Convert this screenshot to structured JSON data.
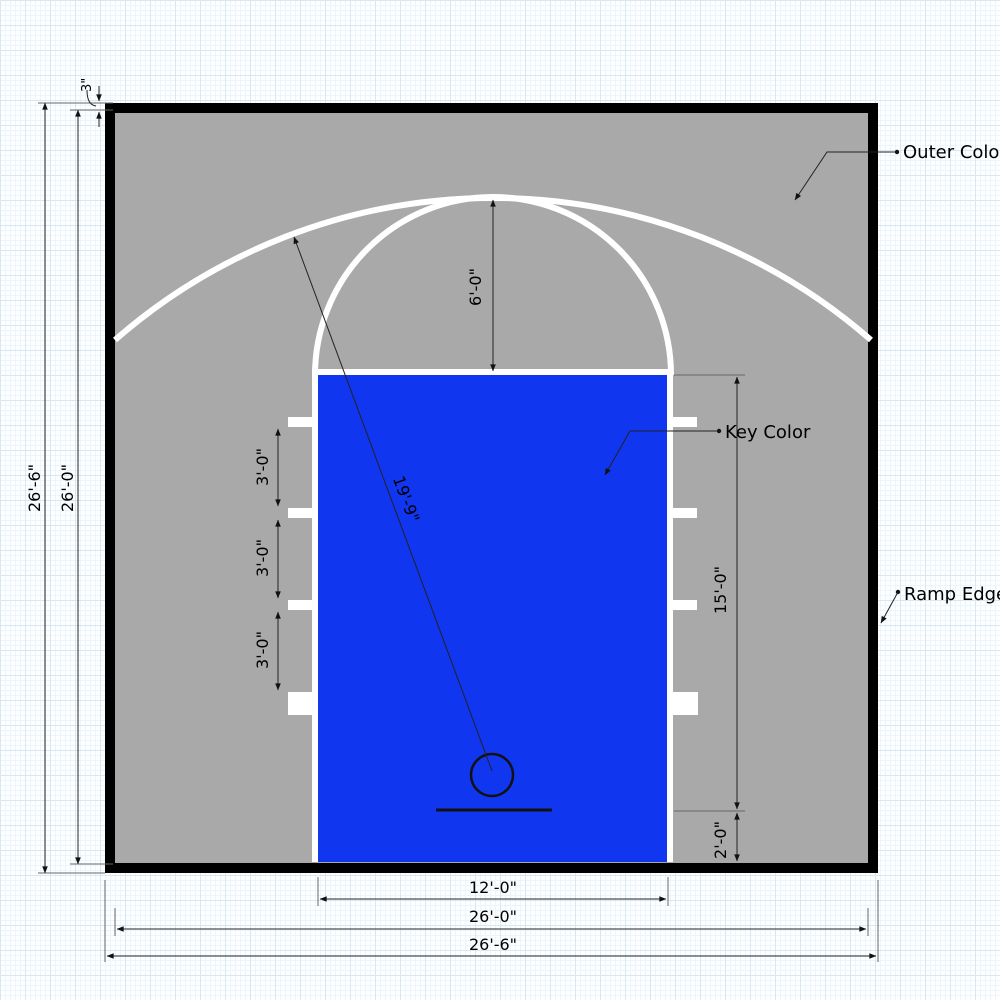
{
  "labels": {
    "outer_color": "Outer Color",
    "key_color": "Key Color",
    "ramp_edges": "Ramp Edges"
  },
  "dimensions": {
    "border_thickness": "3\"",
    "court_height_outer": "26'-6\"",
    "court_height_inner": "26'-0\"",
    "free_throw_radius": "6'-0\"",
    "three_point_radius": "19'-9\"",
    "lane_hash_spacings": [
      "3'-0\"",
      "3'-0\"",
      "3'-0\""
    ],
    "key_length": "15'-0\"",
    "baseline_offset": "2'-0\"",
    "key_width": "12'-0\"",
    "court_width_inner": "26'-0\"",
    "court_width_outer": "26'-6\""
  },
  "colors": {
    "ramp_edge": "#000000",
    "outer_surface": "#a9a9a9",
    "key_surface": "#1136f0",
    "court_lines": "#ffffff"
  }
}
